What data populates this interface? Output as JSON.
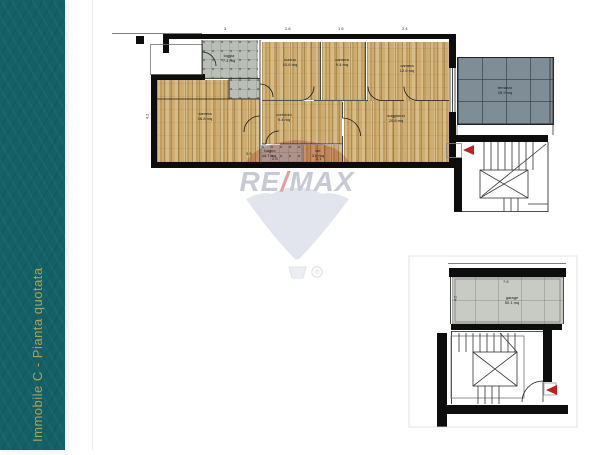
{
  "sidebar": {
    "title": "Immobile C - Pianta quotata"
  },
  "watermark": {
    "brand_re": "RE",
    "brand_slash": "/",
    "brand_max": "MAX",
    "registered": "®",
    "accent_red": "#c41e1e",
    "balloon_gray": "#e2e5ee"
  },
  "plan": {
    "rooms": [
      {
        "name": "loggia",
        "area": "7.4 mq"
      },
      {
        "name": "cucina",
        "area": "10.6 mq"
      },
      {
        "name": "camera",
        "area": "9.4 mq"
      },
      {
        "name": "camera",
        "area": "12.6 mq"
      },
      {
        "name": "soggiorno",
        "area": "20.8 mq"
      },
      {
        "name": "camera",
        "area": "16.8 mq"
      },
      {
        "name": "corridoio",
        "area": "9.4 mq"
      },
      {
        "name": "bagno",
        "area": "4.7 mq"
      },
      {
        "name": "wc",
        "area": "3.6 mq"
      },
      {
        "name": "terrazzo",
        "area": "25.9 mq"
      },
      {
        "name": "garage",
        "area": "50.1 mq"
      }
    ],
    "dimensions": [
      {
        "text": "3"
      },
      {
        "text": "2.6"
      },
      {
        "text": "1.6"
      },
      {
        "text": "2.4"
      },
      {
        "text": "3.5"
      },
      {
        "text": "2.8"
      },
      {
        "text": "2.1"
      },
      {
        "text": "7.6"
      },
      {
        "text": "4.2"
      },
      {
        "text": "4.2"
      }
    ]
  }
}
